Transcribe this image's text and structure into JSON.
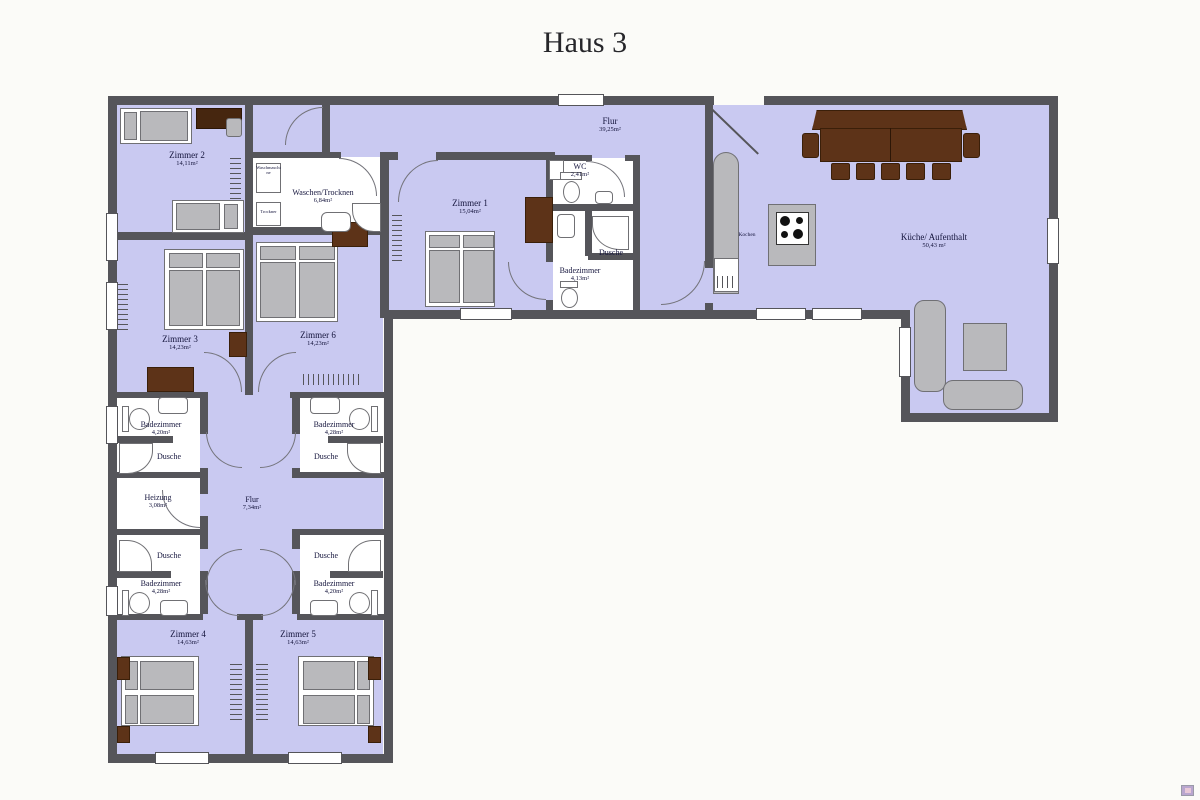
{
  "title": "Haus 3",
  "labels": {
    "zimmer2": {
      "name": "Zimmer 2",
      "area": "14,11m²"
    },
    "zimmer3": {
      "name": "Zimmer 3",
      "area": "14,23m²"
    },
    "zimmer6": {
      "name": "Zimmer 6",
      "area": "14,23m²"
    },
    "zimmer1": {
      "name": "Zimmer 1",
      "area": "15,04m²"
    },
    "zimmer4": {
      "name": "Zimmer 4",
      "area": "14,63m²"
    },
    "zimmer5": {
      "name": "Zimmer 5",
      "area": "14,63m²"
    },
    "waschen": {
      "name": "Waschen/Trocknen",
      "area": "6,84m²"
    },
    "flur_top": {
      "name": "Flur",
      "area": "39,25m²"
    },
    "flur_mitte": {
      "name": "Flur",
      "area": "7,34m²"
    },
    "wc": {
      "name": "WC",
      "area": "2,41m²"
    },
    "bad_mitte": {
      "name": "Badezimmer",
      "area": "4,13m²"
    },
    "dusche_mitte": {
      "name": "Dusche"
    },
    "kueche": {
      "name": "Küche/ Aufenthalt",
      "area": "50,43 m²"
    },
    "kochen": {
      "name": "Kochen"
    },
    "bad_ol": {
      "name": "Badezimmer",
      "area": "4,20m²"
    },
    "dusche_ol": {
      "name": "Dusche"
    },
    "bad_or": {
      "name": "Badezimmer",
      "area": "4,28m²"
    },
    "dusche_or": {
      "name": "Dusche"
    },
    "heizung": {
      "name": "Heizung",
      "area": "3,08m²"
    },
    "bad_ul": {
      "name": "Badezimmer",
      "area": "4,28m²"
    },
    "dusche_ul": {
      "name": "Dusche"
    },
    "bad_ur": {
      "name": "Badezimmer",
      "area": "4,20m²"
    },
    "dusche_ur": {
      "name": "Dusche"
    },
    "appliance_waschmaschine": "Waschmaschine",
    "appliance_trockner": "Trockner"
  },
  "colors": {
    "wall": "#55555a",
    "floor": "#c9c9f1",
    "furniture_gray": "#b9b9bc",
    "furniture_brown": "#5d3318",
    "label_text": "#14143c"
  }
}
